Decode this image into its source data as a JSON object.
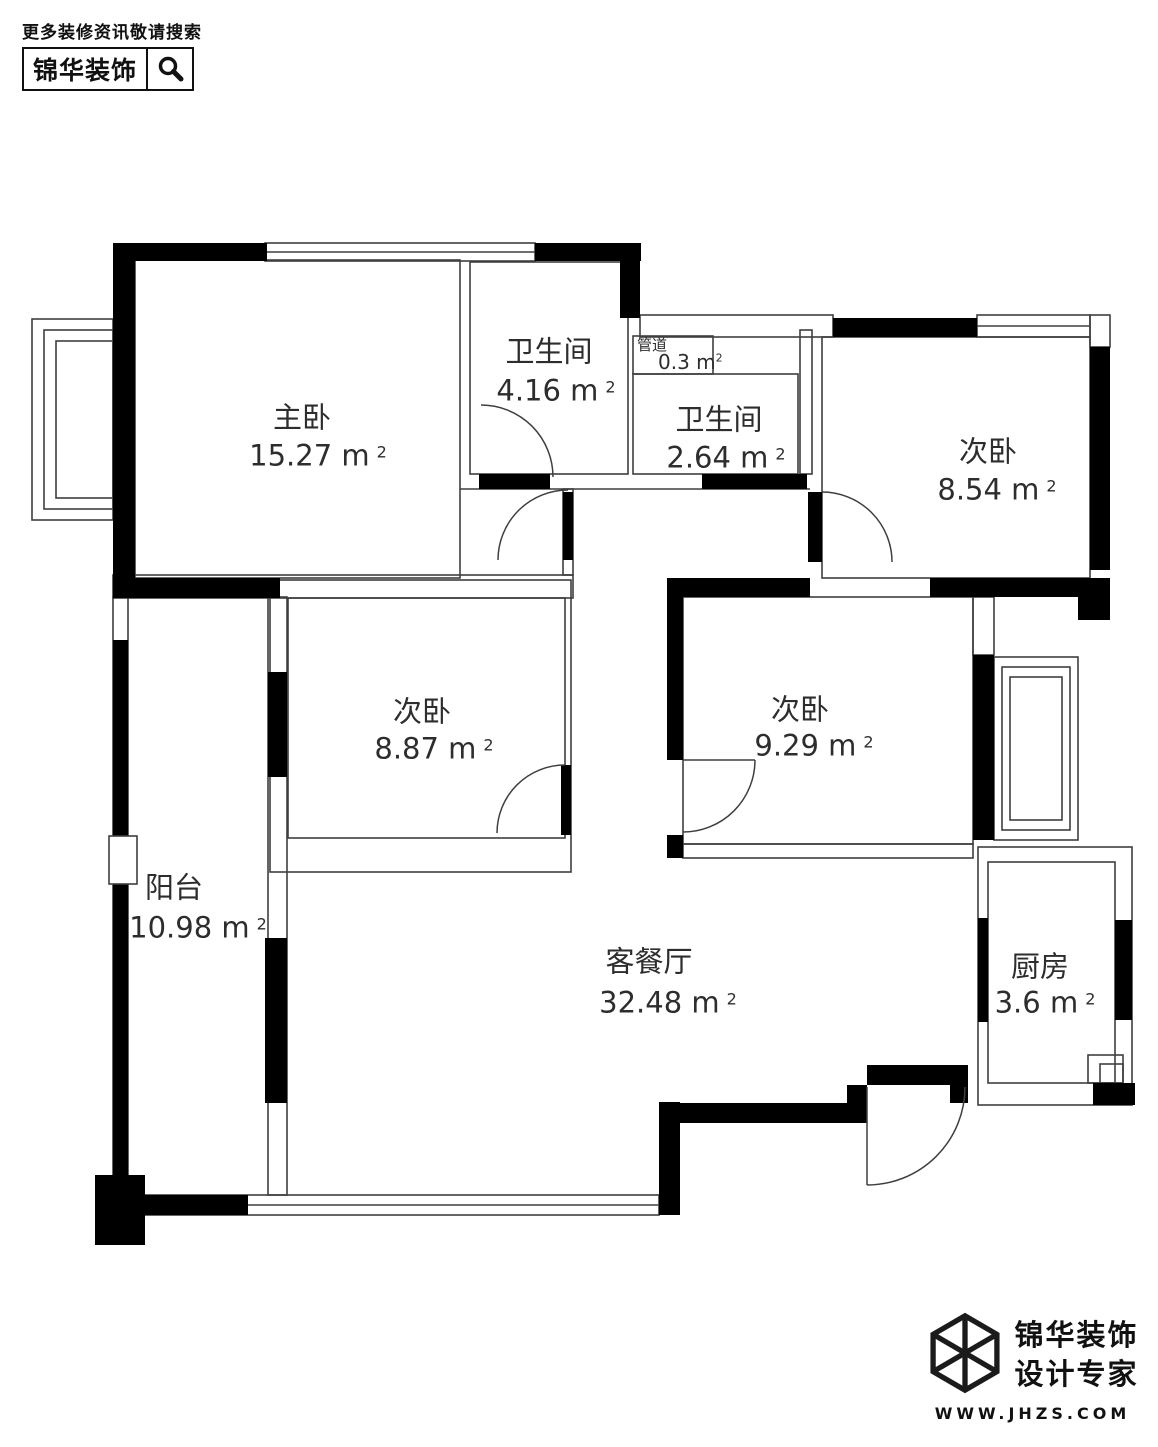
{
  "header": {
    "tagline": "更多装修资讯敬请搜索",
    "brand": "锦华装饰"
  },
  "plan": {
    "area_superscript": "2",
    "rooms": [
      {
        "id": "master-bedroom",
        "label": "主卧",
        "area": "15.27 m"
      },
      {
        "id": "bathroom-1",
        "label": "卫生间",
        "area": "4.16 m"
      },
      {
        "id": "duct",
        "label": "管道",
        "area": "0.3 m"
      },
      {
        "id": "bathroom-2",
        "label": "卫生间",
        "area": "2.64 m"
      },
      {
        "id": "bedroom-2",
        "label": "次卧",
        "area": "8.54 m"
      },
      {
        "id": "bedroom-3",
        "label": "次卧",
        "area": "8.87 m"
      },
      {
        "id": "bedroom-4",
        "label": "次卧",
        "area": "9.29 m"
      },
      {
        "id": "balcony",
        "label": "阳台",
        "area": "10.98 m"
      },
      {
        "id": "living-dining",
        "label": "客餐厅",
        "area": "32.48 m"
      },
      {
        "id": "kitchen",
        "label": "厨房",
        "area": "3.6 m"
      }
    ]
  },
  "footer": {
    "brand_line1": "锦华装饰",
    "brand_line2": "设计专家",
    "website": "WWW.JHZS.COM"
  }
}
